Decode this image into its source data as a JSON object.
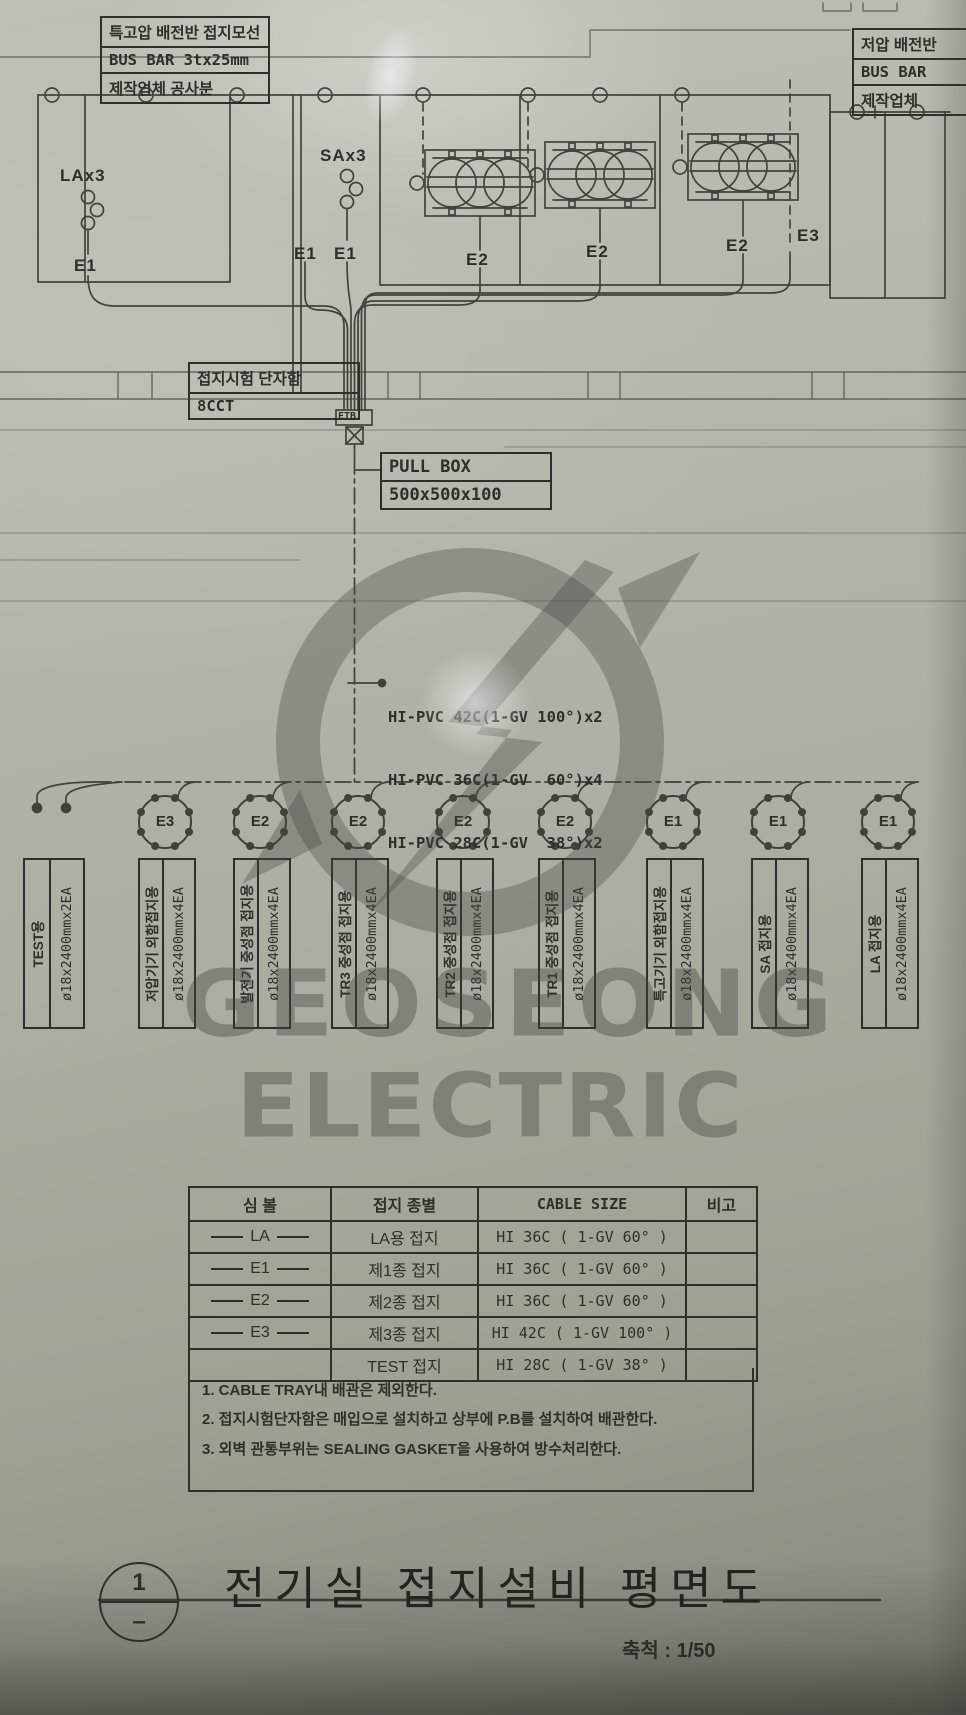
{
  "drawing": {
    "top_left_box": {
      "line1": "특고압 배전반 접지모선",
      "line2": "BUS BAR 3tx25mm",
      "line3": "제작업체 공사분"
    },
    "top_right_box": {
      "line1": "저압 배전반",
      "line2": "BUS BAR",
      "line3": "제작업체"
    },
    "equipment": {
      "la": "LAx3",
      "sa": "SAx3"
    },
    "ground_point_labels": [
      "E1",
      "E1",
      "E1",
      "E2",
      "E2",
      "E2",
      "E3"
    ],
    "etb_box": {
      "line1": "접지시험 단자함",
      "line2": "8CCT"
    },
    "etb_tag": "ETB",
    "pull_box": {
      "line1": "PULL BOX",
      "line2": "500x500x100"
    },
    "conduit_note": {
      "line1": "HI-PVC 42C(1-GV 100°)x2",
      "line2": "HI-PVC 36C(1-GV  60°)x4",
      "line3": "HI-PVC 28C(1-GV  38°)x2"
    }
  },
  "electrodes": [
    {
      "ring": "",
      "use": "TEST용",
      "spec": "ø18x2400mmx2EA"
    },
    {
      "ring": "E3",
      "use": "저압기기 외함접지용",
      "spec": "ø18x2400mmx4EA"
    },
    {
      "ring": "E2",
      "use": "발전기 중성점 접지용",
      "spec": "ø18x2400mmx4EA"
    },
    {
      "ring": "E2",
      "use": "TR3 중성점 접지용",
      "spec": "ø18x2400mmx4EA"
    },
    {
      "ring": "E2",
      "use": "TR2 중성점 접지용",
      "spec": "ø18x2400mmx4EA"
    },
    {
      "ring": "E2",
      "use": "TR1 중성점 접지용",
      "spec": "ø18x2400mmx4EA"
    },
    {
      "ring": "E1",
      "use": "특고기기 외함접지용",
      "spec": "ø18x2400mmx4EA"
    },
    {
      "ring": "E1",
      "use": "SA 접지용",
      "spec": "ø18x2400mmx4EA"
    },
    {
      "ring": "E1",
      "use": "LA 접지용",
      "spec": "ø18x2400mmx4EA"
    }
  ],
  "table": {
    "headers": [
      "심  볼",
      "접지 종별",
      "CABLE SIZE",
      "비고"
    ],
    "rows": [
      {
        "symbol": "LA",
        "kind": "LA용 접지",
        "cable": "HI 36C ( 1-GV 60° )",
        "remark": ""
      },
      {
        "symbol": "E1",
        "kind": "제1종 접지",
        "cable": "HI 36C ( 1-GV 60° )",
        "remark": ""
      },
      {
        "symbol": "E2",
        "kind": "제2종 접지",
        "cable": "HI 36C ( 1-GV 60° )",
        "remark": ""
      },
      {
        "symbol": "E3",
        "kind": "제3종 접지",
        "cable": "HI 42C ( 1-GV 100° )",
        "remark": ""
      },
      {
        "symbol": "",
        "kind": "TEST 접지",
        "cable": "HI 28C ( 1-GV 38° )",
        "remark": ""
      }
    ],
    "notes": [
      "1. CABLE TRAY내 배관은 제외한다.",
      "2. 접지시험단자함은 매입으로 설치하고 상부에 P.B를 설치하여 배관한다.",
      "3. 외벽 관통부위는 SEALING GASKET을 사용하여 방수처리한다."
    ]
  },
  "title_block": {
    "detail_number": "1",
    "detail_sub": "–",
    "title": "전기실 접지설비 평면도",
    "scale": "축척 : 1/50"
  },
  "watermark": {
    "line1": "GEOSEONG",
    "line2": "ELECTRIC"
  }
}
